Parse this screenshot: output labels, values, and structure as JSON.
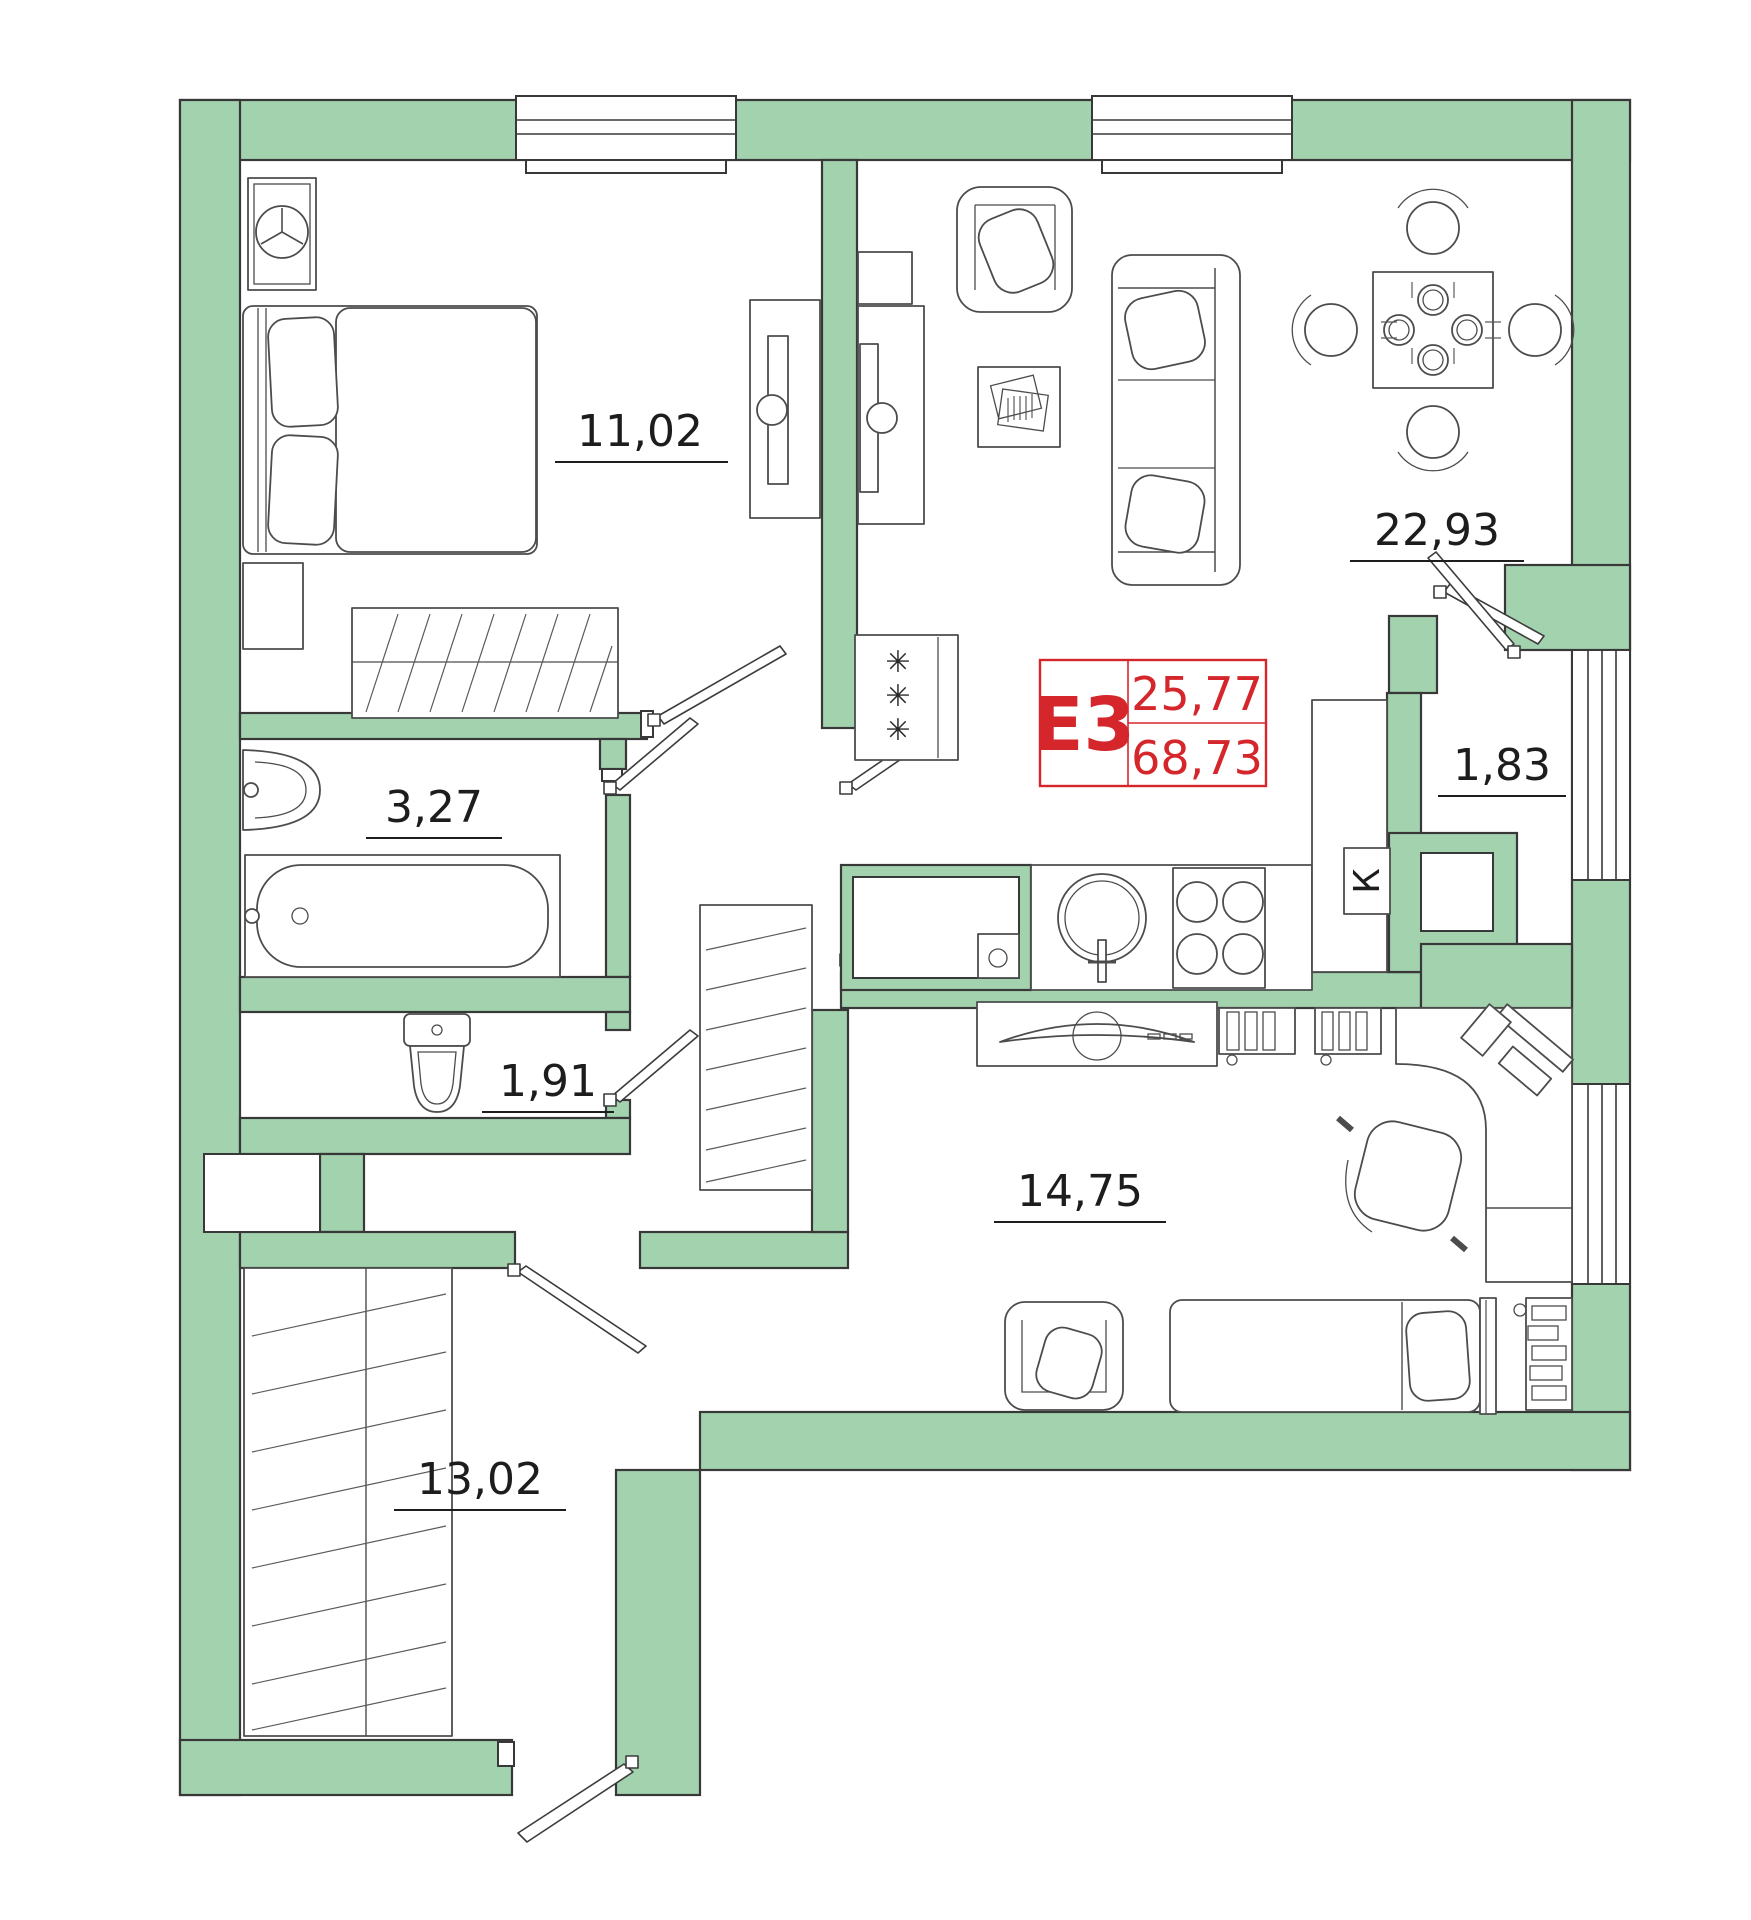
{
  "floorplan": {
    "unit": {
      "label": "Е3",
      "area_living": "25,77",
      "area_total": "68,73"
    },
    "rooms": [
      {
        "key": "bedroom",
        "area": "11,02"
      },
      {
        "key": "living_kitchen",
        "area": "22,93"
      },
      {
        "key": "bathroom",
        "area": "3,27"
      },
      {
        "key": "wc",
        "area": "1,91"
      },
      {
        "key": "hallway_small",
        "area": "1,83"
      },
      {
        "key": "bedroom2",
        "area": "14,75"
      },
      {
        "key": "entrance_hall",
        "area": "13,02"
      }
    ],
    "kitchen_duct_label": "К",
    "fridge_mark": "✳",
    "colors": {
      "wall_fill": "#a3d2ae",
      "line": "#383838",
      "accent_red": "#d5262c",
      "background": "#ffffff"
    }
  }
}
